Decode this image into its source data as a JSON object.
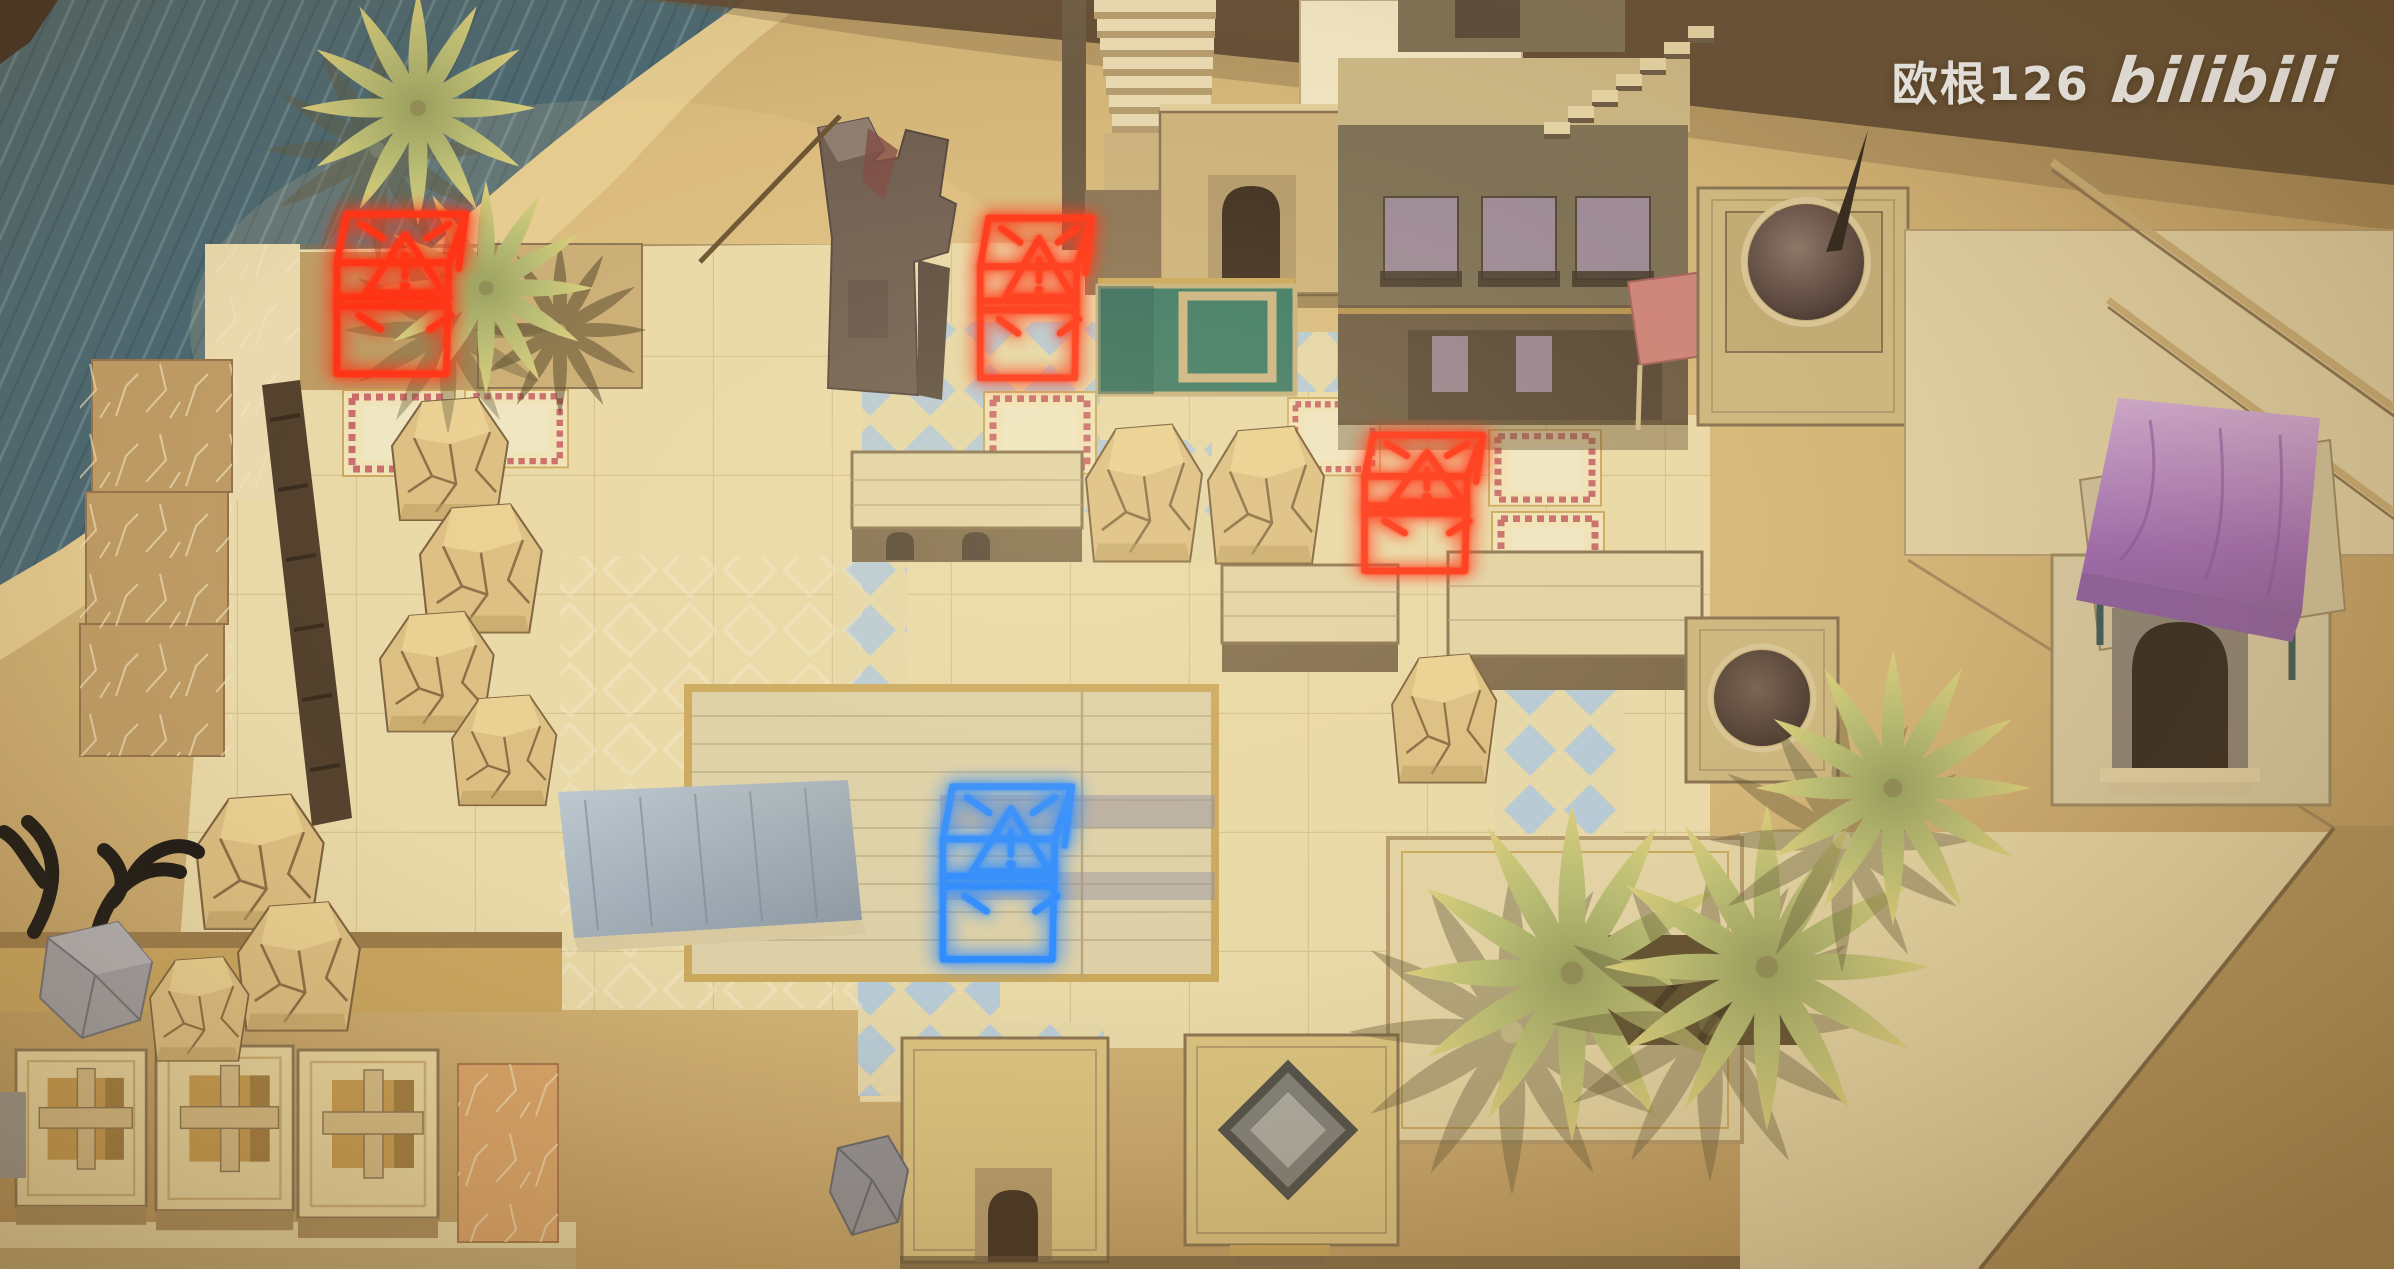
{
  "app": {
    "name": "isometric-desert-town-puzzle"
  },
  "watermark": {
    "username": "欧根126",
    "logo": "bilibili"
  },
  "colors": {
    "sand": "#d2b172",
    "sandLight": "#e6cd92",
    "sandDark": "#b2935b",
    "sandDeep": "#a0824e",
    "duneShadow": "#584430",
    "water": "#476570",
    "waterStreak": "#74929b",
    "plazaTile": "#e9d9a8",
    "tileLine": "#c3ab74",
    "tileBlue": "#b6cad6",
    "paveBrown": "#bd9a63",
    "paveLight": "#ead9ae",
    "building": "#cdb27b",
    "buildingLight": "#e4d3a4",
    "buildingDark": "#8a7352",
    "buildingOlive": "#7e7054",
    "parapet": "#c9b583",
    "roofPlank": "#ddd0a8",
    "archDark": "#3f2f20",
    "windowMauve": "#9d8a96",
    "poolTeal": "#3d7a66",
    "canopyPink": "#cc8478",
    "canopyPurple": "#b288bd",
    "domeDark": "#54413a",
    "rockFill": "#dcbe82",
    "rockLine": "#8a6a42",
    "leafGreen": "#b3b572",
    "leafTip": "#d9cd7b",
    "markerRed": "#ff3214",
    "markerBlue": "#2f8cff",
    "crystalGrey": "#9c9ca3",
    "branchBlack": "#171513",
    "zigzagPink": "#c86a6a",
    "watermarkWhite": "#eceae6"
  },
  "markers": [
    {
      "id": "marker-red-1",
      "kind": "warning-cube",
      "icon": "warning-triangle-icon",
      "color": "#ff3214",
      "x": 332,
      "y": 208,
      "w": 146,
      "h": 172
    },
    {
      "id": "marker-red-2",
      "kind": "warning-cube",
      "icon": "warning-triangle-icon",
      "color": "#ff3214",
      "x": 976,
      "y": 212,
      "w": 126,
      "h": 172
    },
    {
      "id": "marker-red-3",
      "kind": "warning-cube",
      "icon": "warning-triangle-icon",
      "color": "#ff3214",
      "x": 1360,
      "y": 430,
      "w": 134,
      "h": 146
    },
    {
      "id": "marker-blue-1",
      "kind": "warning-cube",
      "icon": "warning-triangle-icon",
      "color": "#2f8cff",
      "x": 938,
      "y": 780,
      "w": 146,
      "h": 186
    }
  ],
  "scene": {
    "setting": "top-down isometric desert town",
    "objects": [
      "waterfall-pool",
      "sand-dunes",
      "tiled-plaza",
      "blue-diamond-tiles",
      "decorated-border-tiles",
      "green-courtyard-pool",
      "building-with-arched-door",
      "staircases",
      "mauve-window-building",
      "pink-canopy-stall",
      "dome-tower",
      "small-dome-tower",
      "purple-canopy-gatehouse",
      "courtyard-building-with-palms",
      "market-roof",
      "blue-grey-ramp",
      "ruined-stone-tower",
      "rock-mounds",
      "palm-trees",
      "black-branch-sculpture",
      "stone-crystals",
      "cross-window-kiosks",
      "roof-rug",
      "warning-cube-markers"
    ]
  }
}
